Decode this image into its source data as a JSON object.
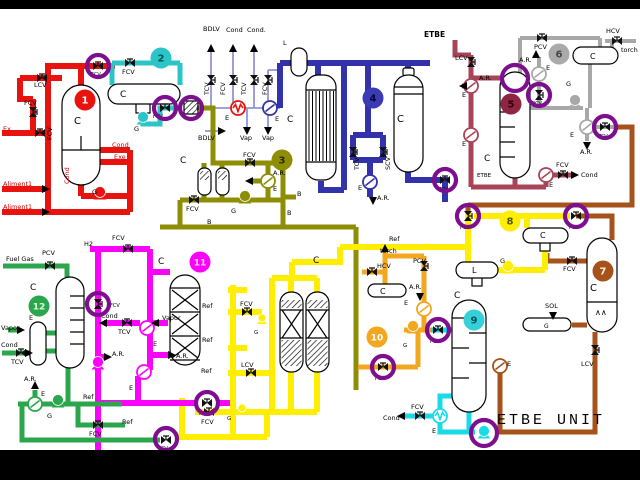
{
  "title": {
    "text": "ETBE UNIT"
  },
  "colors": {
    "red": "#e8120e",
    "teal": "#2cc5c7",
    "olive": "#8e8e05",
    "violet": "#9393d6",
    "navy": "#3232aa",
    "maroon": "#a84458",
    "gray": "#a8a8a8",
    "brown": "#a5521b",
    "yellow": "#ffee00",
    "orange": "#f2a71f",
    "cyan": "#19dbe8",
    "magenta": "#fb02fb",
    "green": "#2ca64c",
    "ring": "#7d0f8f",
    "labeltext": "#000000",
    "redtext": "#d00000"
  },
  "unit_badges": [
    {
      "n": "1",
      "x": 85,
      "y": 100,
      "bg": "#e8120e",
      "fg": "#ffffff"
    },
    {
      "n": "2",
      "x": 161,
      "y": 58,
      "bg": "#2cc5c7",
      "fg": "#045555"
    },
    {
      "n": "3",
      "x": 282,
      "y": 160,
      "bg": "#8e8e05",
      "fg": "#2a2a00"
    },
    {
      "n": "4",
      "x": 373,
      "y": 98,
      "bg": "#3b3bb5",
      "fg": "#000033"
    },
    {
      "n": "5",
      "x": 511,
      "y": 104,
      "bg": "#8f2443",
      "fg": "#2a000a"
    },
    {
      "n": "6",
      "x": 559,
      "y": 54,
      "bg": "#aaaaaa",
      "fg": "#444444"
    },
    {
      "n": "7",
      "x": 603,
      "y": 271,
      "bg": "#a5521b",
      "fg": "#ffeedd"
    },
    {
      "n": "8",
      "x": 510,
      "y": 221,
      "bg": "#ffee00",
      "fg": "#555500"
    },
    {
      "n": "9",
      "x": 474,
      "y": 320,
      "bg": "#35d0d8",
      "fg": "#005555"
    },
    {
      "n": "10",
      "x": 377,
      "y": 337,
      "bg": "#f2a71f",
      "fg": "#ffffff"
    },
    {
      "n": "11",
      "x": 200,
      "y": 262,
      "bg": "#fb02fb",
      "fg": "#ffd0ff"
    },
    {
      "n": "12",
      "x": 39,
      "y": 306,
      "bg": "#2ca64c",
      "fg": "#ddffdd"
    }
  ],
  "labels": [
    {
      "t": "Ex",
      "x": 3,
      "y": 131,
      "c": "#d00000"
    },
    {
      "t": "LCV",
      "x": 34,
      "y": 87
    },
    {
      "t": "FCV",
      "x": 24,
      "y": 105
    },
    {
      "t": "FCV",
      "x": 52,
      "y": 140,
      "r": -90
    },
    {
      "t": "C",
      "x": 74,
      "y": 124,
      "s": 10
    },
    {
      "t": "Cond",
      "x": 112,
      "y": 147,
      "c": "#d00000"
    },
    {
      "t": "Exe",
      "x": 114,
      "y": 159,
      "c": "#d00000"
    },
    {
      "t": "G",
      "x": 92,
      "y": 194
    },
    {
      "t": "Aliment1",
      "x": 3,
      "y": 186,
      "c": "#d00000"
    },
    {
      "t": "Aliment1",
      "x": 3,
      "y": 209,
      "c": "#d00000"
    },
    {
      "t": "Cond",
      "x": 69,
      "y": 184,
      "c": "#d00000",
      "r": -90
    },
    {
      "t": "FCV",
      "x": 91,
      "y": 76,
      "s": 5
    },
    {
      "t": "FCV",
      "x": 122,
      "y": 74
    },
    {
      "t": "C",
      "x": 120,
      "y": 97,
      "s": 9
    },
    {
      "t": "G",
      "x": 134,
      "y": 131
    },
    {
      "t": "FCV",
      "x": 153,
      "y": 118,
      "s": 5
    },
    {
      "t": "C",
      "x": 180,
      "y": 163,
      "s": 9
    },
    {
      "t": "FCV",
      "x": 243,
      "y": 157
    },
    {
      "t": "A.R.",
      "x": 273,
      "y": 175
    },
    {
      "t": "E",
      "x": 273,
      "y": 191
    },
    {
      "t": "FCV",
      "x": 186,
      "y": 211
    },
    {
      "t": "G",
      "x": 231,
      "y": 213
    },
    {
      "t": "B",
      "x": 297,
      "y": 196
    },
    {
      "t": "B",
      "x": 287,
      "y": 215
    },
    {
      "t": "B",
      "x": 207,
      "y": 224
    },
    {
      "t": "BDLV",
      "x": 203,
      "y": 31
    },
    {
      "t": "Cond",
      "x": 226,
      "y": 32
    },
    {
      "t": "Cond.",
      "x": 247,
      "y": 32
    },
    {
      "t": "TCV",
      "x": 209,
      "y": 95,
      "r": -90
    },
    {
      "t": "FCV",
      "x": 225,
      "y": 95,
      "r": -90
    },
    {
      "t": "TCV",
      "x": 246,
      "y": 95,
      "r": -90
    },
    {
      "t": "FCV",
      "x": 267,
      "y": 95,
      "r": -90
    },
    {
      "t": "E",
      "x": 225,
      "y": 120
    },
    {
      "t": "E",
      "x": 275,
      "y": 121
    },
    {
      "t": "BDLV",
      "x": 198,
      "y": 140
    },
    {
      "t": "Vap",
      "x": 240,
      "y": 140
    },
    {
      "t": "Vap",
      "x": 262,
      "y": 140
    },
    {
      "t": "L",
      "x": 283,
      "y": 45
    },
    {
      "t": "C",
      "x": 287,
      "y": 122,
      "s": 9
    },
    {
      "t": "C",
      "x": 397,
      "y": 122,
      "s": 10
    },
    {
      "t": "TCV",
      "x": 359,
      "y": 170,
      "r": -90
    },
    {
      "t": "SCV",
      "x": 390,
      "y": 170,
      "r": -90
    },
    {
      "t": "E",
      "x": 358,
      "y": 190
    },
    {
      "t": "A.R.",
      "x": 377,
      "y": 200
    },
    {
      "t": "TCV",
      "x": 438,
      "y": 191,
      "s": 5
    },
    {
      "t": "ETBE",
      "x": 424,
      "y": 37,
      "b": 1,
      "s": 7.5
    },
    {
      "t": "LCV",
      "x": 455,
      "y": 60
    },
    {
      "t": "A.R.",
      "x": 479,
      "y": 80
    },
    {
      "t": "E",
      "x": 462,
      "y": 97
    },
    {
      "t": "E",
      "x": 462,
      "y": 146
    },
    {
      "t": "C",
      "x": 484,
      "y": 161,
      "s": 9
    },
    {
      "t": "ETBE",
      "x": 477,
      "y": 177,
      "s": 5.5
    },
    {
      "t": "E",
      "x": 549,
      "y": 187
    },
    {
      "t": "FCV",
      "x": 556,
      "y": 167
    },
    {
      "t": "Cond",
      "x": 581,
      "y": 177
    },
    {
      "t": "PCV",
      "x": 534,
      "y": 49
    },
    {
      "t": "HCV",
      "x": 606,
      "y": 33
    },
    {
      "t": "torch",
      "x": 621,
      "y": 52
    },
    {
      "t": "C",
      "x": 590,
      "y": 59,
      "s": 8
    },
    {
      "t": "A.R.",
      "x": 519,
      "y": 62
    },
    {
      "t": "E",
      "x": 546,
      "y": 70
    },
    {
      "t": "G",
      "x": 566,
      "y": 86
    },
    {
      "t": "PCV",
      "x": 532,
      "y": 105,
      "s": 5
    },
    {
      "t": "E",
      "x": 570,
      "y": 137
    },
    {
      "t": "A.R.",
      "x": 580,
      "y": 154
    },
    {
      "t": "TCV",
      "x": 598,
      "y": 138,
      "s": 5
    },
    {
      "t": "PCV",
      "x": 569,
      "y": 229,
      "s": 5
    },
    {
      "t": "FCV",
      "x": 563,
      "y": 271
    },
    {
      "t": "C",
      "x": 590,
      "y": 291,
      "s": 10
    },
    {
      "t": "∧∧",
      "x": 595,
      "y": 315,
      "s": 8
    },
    {
      "t": "SOL",
      "x": 545,
      "y": 308
    },
    {
      "t": "G",
      "x": 544,
      "y": 328,
      "s": 6
    },
    {
      "t": "LCV",
      "x": 581,
      "y": 366
    },
    {
      "t": "E",
      "x": 507,
      "y": 366
    },
    {
      "t": "Ref",
      "x": 389,
      "y": 241
    },
    {
      "t": "FCV",
      "x": 460,
      "y": 229,
      "s": 5
    },
    {
      "t": "C",
      "x": 540,
      "y": 238,
      "s": 8
    },
    {
      "t": "G",
      "x": 500,
      "y": 263
    },
    {
      "t": "L",
      "x": 472,
      "y": 273,
      "s": 8
    },
    {
      "t": "C",
      "x": 313,
      "y": 263,
      "s": 9
    },
    {
      "t": "Ref",
      "x": 202,
      "y": 308
    },
    {
      "t": "Ref",
      "x": 202,
      "y": 342
    },
    {
      "t": "FCV",
      "x": 240,
      "y": 306
    },
    {
      "t": "G",
      "x": 254,
      "y": 334,
      "s": 5.5
    },
    {
      "t": "LCV",
      "x": 241,
      "y": 367
    },
    {
      "t": "Ref",
      "x": 201,
      "y": 373
    },
    {
      "t": "FCV",
      "x": 201,
      "y": 424
    },
    {
      "t": "G",
      "x": 227,
      "y": 420,
      "s": 5.5
    },
    {
      "t": "torch",
      "x": 380,
      "y": 253
    },
    {
      "t": "HCV",
      "x": 377,
      "y": 268
    },
    {
      "t": "PCV",
      "x": 413,
      "y": 263
    },
    {
      "t": "C",
      "x": 380,
      "y": 294,
      "s": 8
    },
    {
      "t": "A.R.",
      "x": 409,
      "y": 289
    },
    {
      "t": "E",
      "x": 404,
      "y": 305
    },
    {
      "t": "G",
      "x": 403,
      "y": 347,
      "s": 5.5
    },
    {
      "t": "FCV",
      "x": 430,
      "y": 343,
      "s": 5
    },
    {
      "t": "FCV",
      "x": 375,
      "y": 380,
      "s": 5
    },
    {
      "t": "C",
      "x": 454,
      "y": 298,
      "s": 9
    },
    {
      "t": "FCV",
      "x": 411,
      "y": 409
    },
    {
      "t": "Cond",
      "x": 383,
      "y": 420
    },
    {
      "t": "E",
      "x": 432,
      "y": 433
    },
    {
      "t": "C",
      "x": 158,
      "y": 264,
      "s": 9
    },
    {
      "t": "FCV",
      "x": 112,
      "y": 240
    },
    {
      "t": "H2",
      "x": 84,
      "y": 246
    },
    {
      "t": "FCV",
      "x": 110,
      "y": 307,
      "s": 5
    },
    {
      "t": "Cond",
      "x": 101,
      "y": 318
    },
    {
      "t": "TCV",
      "x": 118,
      "y": 334
    },
    {
      "t": "E",
      "x": 153,
      "y": 346
    },
    {
      "t": "Vapor",
      "x": 162,
      "y": 320
    },
    {
      "t": "A.R.",
      "x": 176,
      "y": 358
    },
    {
      "t": "A.R.",
      "x": 112,
      "y": 356
    },
    {
      "t": "E",
      "x": 129,
      "y": 390
    },
    {
      "t": "FCV",
      "x": 199,
      "y": 415,
      "s": 5
    },
    {
      "t": "PCV",
      "x": 42,
      "y": 255
    },
    {
      "t": "Fuel Gas",
      "x": 6,
      "y": 261
    },
    {
      "t": "C",
      "x": 30,
      "y": 290,
      "s": 9
    },
    {
      "t": "E",
      "x": 29,
      "y": 320
    },
    {
      "t": "Vapor",
      "x": 1,
      "y": 330
    },
    {
      "t": "Cond",
      "x": 1,
      "y": 347
    },
    {
      "t": "TCV",
      "x": 11,
      "y": 364
    },
    {
      "t": "A.R.",
      "x": 24,
      "y": 381
    },
    {
      "t": "E",
      "x": 41,
      "y": 396
    },
    {
      "t": "G",
      "x": 47,
      "y": 418
    },
    {
      "t": "Ref",
      "x": 83,
      "y": 399
    },
    {
      "t": "FCV",
      "x": 89,
      "y": 436
    },
    {
      "t": "Ref",
      "x": 122,
      "y": 424
    },
    {
      "t": "FCV",
      "x": 158,
      "y": 450,
      "s": 5
    }
  ],
  "valves": [
    {
      "x": 98,
      "y": 66,
      "o": "h"
    },
    {
      "x": 42,
      "y": 78,
      "o": "h"
    },
    {
      "x": 33,
      "y": 112,
      "o": "v"
    },
    {
      "x": 40,
      "y": 133,
      "o": "h"
    },
    {
      "x": 130,
      "y": 63,
      "o": "h"
    },
    {
      "x": 165,
      "y": 108,
      "o": "h"
    },
    {
      "x": 250,
      "y": 163,
      "o": "h"
    },
    {
      "x": 194,
      "y": 200,
      "o": "h"
    },
    {
      "x": 211,
      "y": 80,
      "o": "v"
    },
    {
      "x": 233,
      "y": 80,
      "o": "v"
    },
    {
      "x": 254,
      "y": 80,
      "o": "v"
    },
    {
      "x": 268,
      "y": 80,
      "o": "v"
    },
    {
      "x": 353,
      "y": 152,
      "o": "v"
    },
    {
      "x": 383,
      "y": 152,
      "o": "v"
    },
    {
      "x": 445,
      "y": 180,
      "o": "h"
    },
    {
      "x": 471,
      "y": 62,
      "o": "v"
    },
    {
      "x": 563,
      "y": 175,
      "o": "h"
    },
    {
      "x": 542,
      "y": 38,
      "o": "h"
    },
    {
      "x": 617,
      "y": 41,
      "o": "h"
    },
    {
      "x": 539,
      "y": 95,
      "o": "v"
    },
    {
      "x": 605,
      "y": 127,
      "o": "h"
    },
    {
      "x": 576,
      "y": 216,
      "o": "h"
    },
    {
      "x": 572,
      "y": 261,
      "o": "h"
    },
    {
      "x": 595,
      "y": 350,
      "o": "v"
    },
    {
      "x": 468,
      "y": 216,
      "o": "v"
    },
    {
      "x": 247,
      "y": 312,
      "o": "h"
    },
    {
      "x": 251,
      "y": 373,
      "o": "h"
    },
    {
      "x": 209,
      "y": 412,
      "o": "h"
    },
    {
      "x": 372,
      "y": 272,
      "o": "h"
    },
    {
      "x": 424,
      "y": 266,
      "o": "v"
    },
    {
      "x": 438,
      "y": 330,
      "o": "h"
    },
    {
      "x": 383,
      "y": 367,
      "o": "h"
    },
    {
      "x": 420,
      "y": 416,
      "o": "h"
    },
    {
      "x": 128,
      "y": 249,
      "o": "h"
    },
    {
      "x": 98,
      "y": 304,
      "o": "v"
    },
    {
      "x": 127,
      "y": 323,
      "o": "h"
    },
    {
      "x": 207,
      "y": 403,
      "o": "h"
    },
    {
      "x": 50,
      "y": 266,
      "o": "h"
    },
    {
      "x": 21,
      "y": 353,
      "o": "h"
    },
    {
      "x": 98,
      "y": 425,
      "o": "h"
    },
    {
      "x": 166,
      "y": 440,
      "o": "h"
    }
  ],
  "pumps": [
    {
      "x": 100,
      "y": 192,
      "c": "red"
    },
    {
      "x": 143,
      "y": 117,
      "c": "teal"
    },
    {
      "x": 245,
      "y": 196,
      "c": "olive"
    },
    {
      "x": 575,
      "y": 100,
      "c": "gray"
    },
    {
      "x": 508,
      "y": 266,
      "c": "yellow"
    },
    {
      "x": 262,
      "y": 318,
      "c": "yellow",
      "sm": 1
    },
    {
      "x": 242,
      "y": 408,
      "c": "yellow",
      "sm": 1
    },
    {
      "x": 413,
      "y": 326,
      "c": "orange"
    },
    {
      "x": 98,
      "y": 362,
      "c": "magenta"
    },
    {
      "x": 58,
      "y": 400,
      "c": "green"
    },
    {
      "x": 484,
      "y": 431,
      "c": "cyan"
    }
  ],
  "exchangers": [
    {
      "x": 238,
      "y": 108,
      "c": "red",
      "zig": 1
    },
    {
      "x": 270,
      "y": 108,
      "c": "navy"
    },
    {
      "x": 268,
      "y": 181,
      "c": "olive"
    },
    {
      "x": 370,
      "y": 182,
      "c": "navy"
    },
    {
      "x": 471,
      "y": 86,
      "c": "maroon"
    },
    {
      "x": 471,
      "y": 135,
      "c": "maroon"
    },
    {
      "x": 546,
      "y": 175,
      "c": "maroon"
    },
    {
      "x": 539,
      "y": 74,
      "c": "gray"
    },
    {
      "x": 587,
      "y": 127,
      "c": "gray"
    },
    {
      "x": 500,
      "y": 366,
      "c": "brown"
    },
    {
      "x": 424,
      "y": 309,
      "c": "orange"
    },
    {
      "x": 440,
      "y": 416,
      "c": "cyan",
      "zig": 1
    },
    {
      "x": 147,
      "y": 328,
      "c": "magenta"
    },
    {
      "x": 144,
      "y": 372,
      "c": "magenta"
    },
    {
      "x": 35,
      "y": 404,
      "c": "green"
    }
  ],
  "rings": [
    {
      "x": 98,
      "y": 66
    },
    {
      "x": 165,
      "y": 108
    },
    {
      "x": 191,
      "y": 108
    },
    {
      "x": 445,
      "y": 180
    },
    {
      "x": 468,
      "y": 216
    },
    {
      "x": 515,
      "y": 78,
      "r": 13
    },
    {
      "x": 539,
      "y": 95
    },
    {
      "x": 605,
      "y": 127
    },
    {
      "x": 576,
      "y": 216
    },
    {
      "x": 438,
      "y": 330
    },
    {
      "x": 383,
      "y": 367
    },
    {
      "x": 98,
      "y": 304
    },
    {
      "x": 207,
      "y": 403
    },
    {
      "x": 166,
      "y": 439
    },
    {
      "x": 484,
      "y": 433,
      "r": 13
    }
  ],
  "arrows": [
    {
      "x": 211,
      "y": 49,
      "d": "up"
    },
    {
      "x": 233,
      "y": 49,
      "d": "up"
    },
    {
      "x": 254,
      "y": 49,
      "d": "up"
    },
    {
      "x": 536,
      "y": 55,
      "d": "up"
    },
    {
      "x": 35,
      "y": 386,
      "d": "up"
    },
    {
      "x": 385,
      "y": 249,
      "d": "up"
    },
    {
      "x": 247,
      "y": 130,
      "d": "down"
    },
    {
      "x": 268,
      "y": 130,
      "d": "down"
    },
    {
      "x": 373,
      "y": 200,
      "d": "down"
    },
    {
      "x": 587,
      "y": 145,
      "d": "down"
    },
    {
      "x": 420,
      "y": 296,
      "d": "down"
    },
    {
      "x": 553,
      "y": 315,
      "d": "down"
    },
    {
      "x": 464,
      "y": 86,
      "d": "left"
    },
    {
      "x": 104,
      "y": 323,
      "d": "left"
    },
    {
      "x": 156,
      "y": 323,
      "d": "left"
    },
    {
      "x": 402,
      "y": 416,
      "d": "left"
    },
    {
      "x": 250,
      "y": 181,
      "d": "left"
    },
    {
      "x": 574,
      "y": 175,
      "d": "right"
    },
    {
      "x": 45,
      "y": 189,
      "d": "right"
    },
    {
      "x": 45,
      "y": 212,
      "d": "right"
    },
    {
      "x": 221,
      "y": 131,
      "d": "right"
    },
    {
      "x": 171,
      "y": 355,
      "d": "right"
    },
    {
      "x": 107,
      "y": 357,
      "d": "right"
    },
    {
      "x": 20,
      "y": 330,
      "d": "right"
    },
    {
      "x": 28,
      "y": 353,
      "d": "right"
    }
  ]
}
